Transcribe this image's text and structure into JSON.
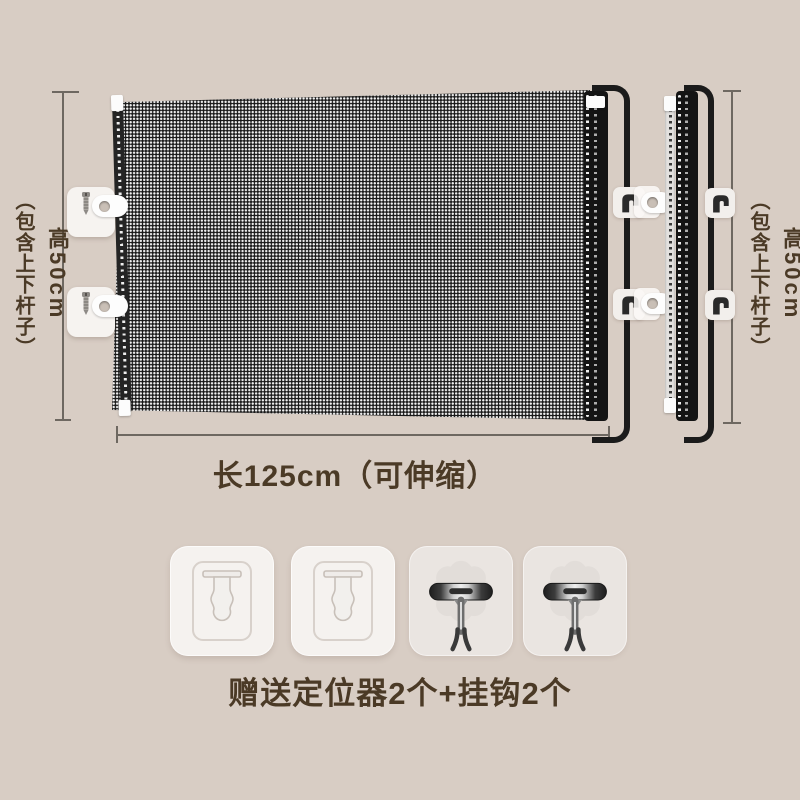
{
  "page": {
    "background": "#d8cdc4",
    "text_color": "#4b3a26",
    "line_color": "#6e6861",
    "mesh_color": "#171717"
  },
  "labels": {
    "left": {
      "height": "高50cm",
      "note": "（包含上下杆子）"
    },
    "right": {
      "height": "高50cm",
      "note": "（包含上下杆子）"
    },
    "length": "长125cm（可伸缩）",
    "gift": "赠送定位器2个+挂钩2个"
  },
  "product": {
    "main_view": "retractable-mesh-panel-extended",
    "side_view": "retractable-mesh-panel-collapsed"
  },
  "accessories": {
    "items": [
      {
        "type": "positioner",
        "icon": "keyhole-mount-icon"
      },
      {
        "type": "positioner",
        "icon": "keyhole-mount-icon"
      },
      {
        "type": "hook",
        "icon": "adhesive-hook-icon"
      },
      {
        "type": "hook",
        "icon": "adhesive-hook-icon"
      }
    ]
  }
}
